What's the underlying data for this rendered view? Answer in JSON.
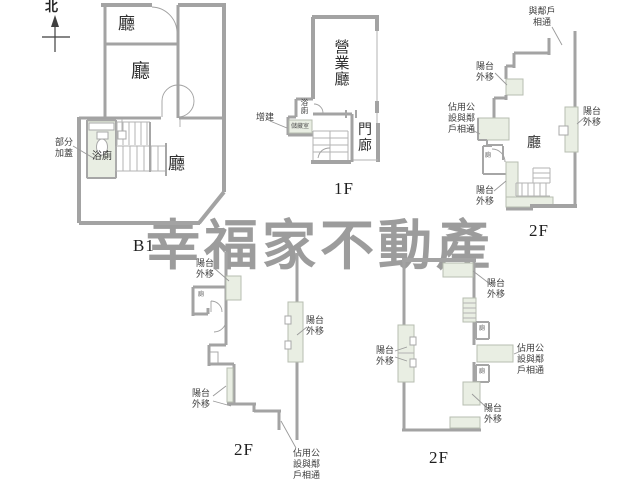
{
  "watermark": "幸福家不動產",
  "compass": {
    "north": "北"
  },
  "colors": {
    "wall": "#a3a3a3",
    "shade": "#e9eee3",
    "watermark": "#9c9c9c",
    "pointer": "#9a9a9a"
  },
  "b1": {
    "caption": "B1",
    "hall_top": "廳",
    "hall_mid": "廳",
    "hall_low": "廳",
    "bath": "浴廁",
    "partial_addition": "部分\n加蓋"
  },
  "f1": {
    "caption": "1F",
    "business_hall": "營\n業\n廳",
    "porch": "門\n廊",
    "bath": "浴\n廁",
    "storage": "儲藏室",
    "addition": "增建"
  },
  "f2a": {
    "caption": "2F",
    "hall": "廳",
    "toilet": "廁",
    "neighbor_link": "與鄰戶\n相通",
    "balcony_top": "陽台\n外移",
    "balcony_right": "陽台\n外移",
    "balcony_bottom": "陽台\n外移",
    "public_occupy": "佔用公\n設與鄰\n戶相通"
  },
  "f2b": {
    "caption": "2F",
    "toilet": "廁",
    "balcony_top": "陽台\n外移",
    "balcony_bottom": "陽台\n外移"
  },
  "strip": {
    "balcony": "陽台\n外移",
    "public_occupy": "佔用公\n設與鄰\n戶相通"
  },
  "f2c": {
    "caption": "2F",
    "toilet_top": "廁",
    "toilet_bottom": "廁",
    "balcony_top": "陽台\n外移",
    "balcony_left": "陽台\n外移",
    "balcony_bottom": "陽台\n外移",
    "public_occupy": "佔用公\n設與鄰\n戶相通"
  }
}
